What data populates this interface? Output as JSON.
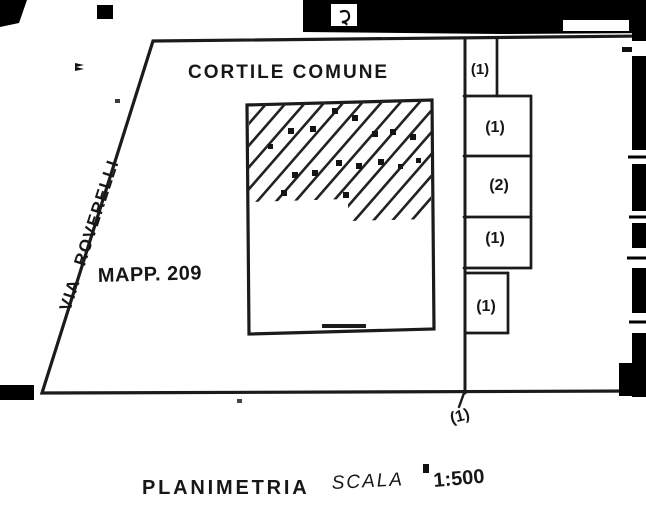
{
  "document": {
    "type_label": "PLANIMETRIA",
    "scale_word": "SCALA",
    "scale_value": "1:500"
  },
  "plan": {
    "courtyard_label": "CORTILE COMUNE",
    "street_label": "VIA ROVERELLI",
    "parcel_label": "MAPP. 209",
    "unit_labels": [
      "(1)",
      "(1)",
      "(2)",
      "(1)",
      "(1)"
    ],
    "access_label": "(1)"
  },
  "colors": {
    "ink": "#1b1b1b",
    "paper": "#ffffff",
    "scan_border": "#000000"
  }
}
